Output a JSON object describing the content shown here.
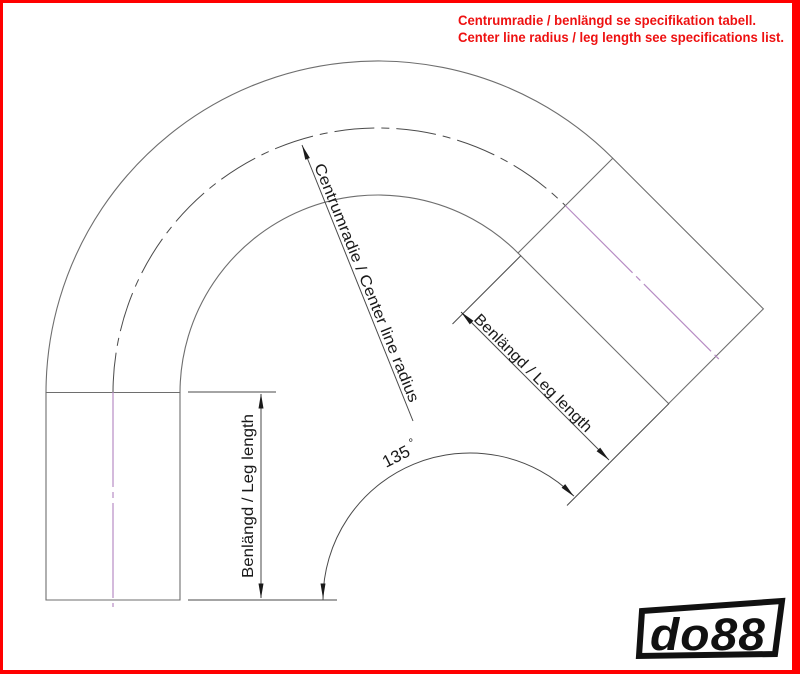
{
  "frame": {
    "border_color": "#ff0000",
    "background": "#ffffff"
  },
  "note": {
    "color": "#ee1111",
    "line1": "Centrumradie / benlängd se specifikation tabell.",
    "line2": "Center line radius / leg length see specifications list."
  },
  "drawing": {
    "line_color": "#6e6e6e",
    "dim_color": "#4a4a4a",
    "arrow_color": "#1a1a1a",
    "centerline_color": "#b78cc4",
    "center_radius_label": "Centrumradie / Center line radius",
    "left_leg_label": "Benlängd / Leg length",
    "right_leg_label": "Benlängd / Leg length",
    "angle_value": "135",
    "angle_degree": "°"
  },
  "logo": {
    "text": "do88",
    "color": "#111111"
  }
}
